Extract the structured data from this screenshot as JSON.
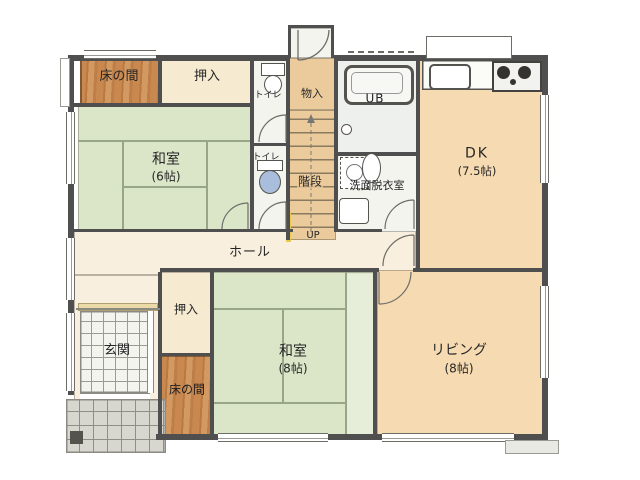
{
  "plan": {
    "rooms": {
      "tokonoma_top": {
        "label": "床の間"
      },
      "oshiire_top": {
        "label": "押入"
      },
      "washitsu6": {
        "label": "和室",
        "size": "(6帖)"
      },
      "toilet_top": {
        "label": "トイレ"
      },
      "toilet_bottom": {
        "label": "トイレ"
      },
      "monoire": {
        "label": "物入"
      },
      "stairs": {
        "label": "階段",
        "direction": "UP"
      },
      "unit_bath": {
        "label": "UB"
      },
      "washroom": {
        "label": "洗面脱衣室"
      },
      "dk": {
        "label": "DK",
        "size": "(7.5帖)"
      },
      "hall": {
        "label": "ホール"
      },
      "genkan": {
        "label": "玄関"
      },
      "oshiire_bottom": {
        "label": "押入"
      },
      "tokonoma_bottom": {
        "label": "床の間"
      },
      "washitsu8": {
        "label": "和室",
        "size": "(8帖)"
      },
      "living": {
        "label": "リビング",
        "size": "(8帖)"
      }
    },
    "colors": {
      "wall": "#4f4f4f",
      "tatami": "#dbe6c9",
      "tatami_light": "#e6eed9",
      "wood": "#c9884f",
      "closet": "#f6ebd1",
      "dining": "#f6dbb2",
      "hall_floor": "#f9efde",
      "stair_floor": "#ebcb9b",
      "bath_floor": "#eef0ee",
      "tile_white": "#f4f4ef",
      "porch_tile": "#d7d7d0",
      "toilet_blue": "#a9bddc",
      "accent_yellow": "#e9c94f"
    }
  }
}
